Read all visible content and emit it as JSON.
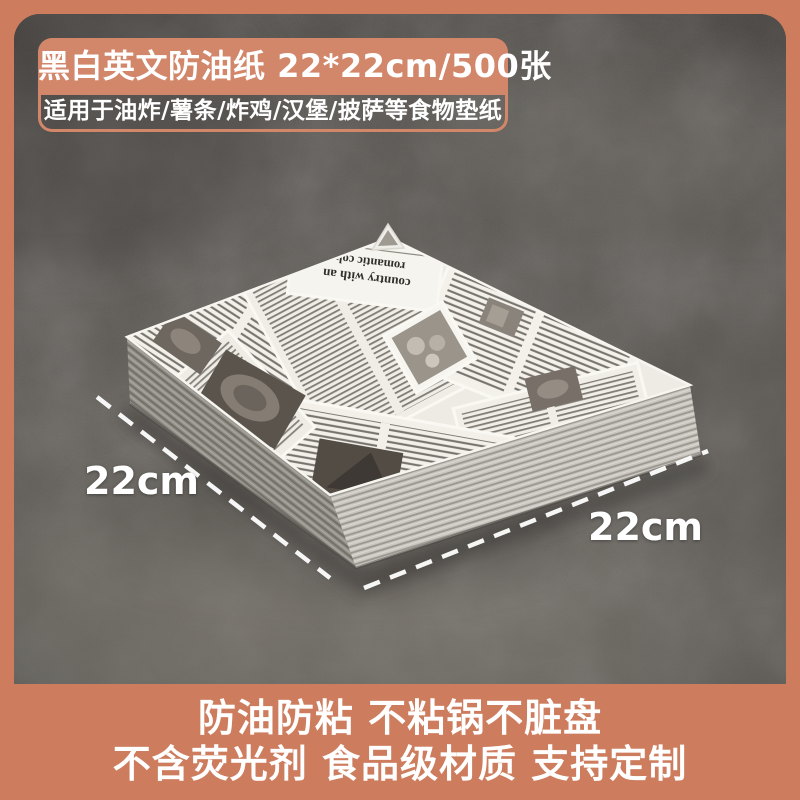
{
  "theme": {
    "accent_color": "#cd7d5e",
    "badge_fill_color": "#d2866a",
    "text_color": "#ffffff",
    "concrete_dark_color": "#514d49",
    "concrete_light_color": "#716d66",
    "paper_color": "#f2efe9"
  },
  "header_badge": {
    "title": "黑白英文防油纸 22*22cm/500张",
    "subtitle": "适用于油炸/薯条/炸鸡/汉堡/披萨等食物垫纸"
  },
  "dimension_labels": {
    "left": "22cm",
    "right": "22cm"
  },
  "paper_stack": {
    "headline_line1": "country with an",
    "headline_line2": "romantic colu"
  },
  "footer_banner": {
    "line1": "防油防粘 不粘锅不脏盘",
    "line2": "不含荧光剂 食品级材质 支持定制"
  }
}
